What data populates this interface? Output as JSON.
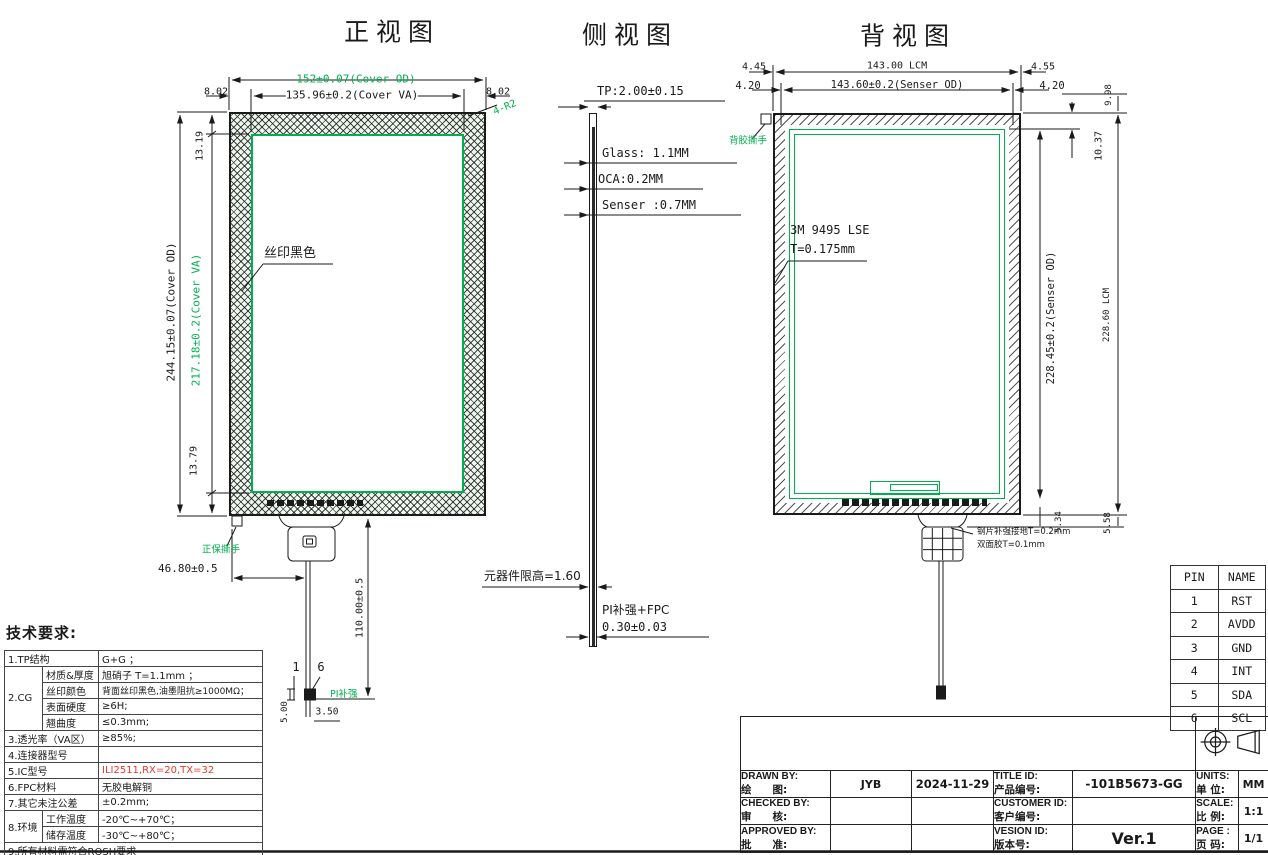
{
  "colors": {
    "line": "#1a1a1a",
    "green": "#00b050",
    "red": "#e8392c"
  },
  "front": {
    "title": "正视图",
    "dim_cover_od": "152±0.07(Cover OD)",
    "dim_cover_va": "135.96±0.2(Cover VA)",
    "margin_left": "8.02",
    "margin_right": "8.02",
    "corner": "4-R2",
    "height_od": "244.15±0.07(Cover OD)",
    "height_va": "217.18±0.2(Cover VA)",
    "top_margin": "13.19",
    "bottom_margin": "13.79",
    "silkscreen": "丝印黑色",
    "tear": "正保撕手",
    "tail_offset": "46.80±0.5",
    "tail_len": "110.00±0.5",
    "pin_start": "1",
    "pin_end": "6",
    "pad_h": "5.00",
    "pad_w": "3.50",
    "pi": "PI补强"
  },
  "side": {
    "title": "侧视图",
    "tp": "TP:2.00±0.15",
    "glass": "Glass: 1.1MM",
    "oca": "OCA:0.2MM",
    "sensor": "Senser :0.7MM",
    "comp_limit": "元器件限高=1.60",
    "pi1": "PI补强+FPC",
    "pi2": "0.30±0.03"
  },
  "back": {
    "title": "背视图",
    "m445": "4.45",
    "lcm_w": "143.00 LCM",
    "m455": "4.55",
    "m420l": "4.20",
    "senser_w": "143.60±0.2(Senser OD)",
    "m420r": "4.20",
    "tear": "背胶撕手",
    "adh1": "3M 9495 LSE",
    "adh2": "T=0.175mm",
    "m998": "9.98",
    "m1037": "10.37",
    "senser_h": "228.45±0.2(Senser OD)",
    "lcm_h": "228.60 LCM",
    "m534": "5.34",
    "m558": "5.58",
    "steel1": "钢片补强接地T=0.2mm",
    "steel2": "双面胶T=0.1mm"
  },
  "tech": {
    "heading": "技术要求:",
    "r1_label": "1.TP结构",
    "r1_value": "G+G ；",
    "cg_group": "2.CG",
    "cg1_label": "材质&厚度",
    "cg1_value": "旭硝子 T=1.1mm ；",
    "cg2_label": "丝印颜色",
    "cg2_value": "背面丝印黑色,油墨阻抗≥1000MΩ；",
    "cg3_label": "表面硬度",
    "cg3_value": "≥6H;",
    "cg4_label": "翘曲度",
    "cg4_value": "≤0.3mm;",
    "r3_label": "3.透光率（VA区）",
    "r3_value": "≥85%;",
    "r4_label": "4.连接器型号",
    "r4_value": "",
    "r5_label": "5.IC型号",
    "r5_value": "ILI2511,RX=20,TX=32",
    "r6_label": "6.FPC材料",
    "r6_value": "无胶电解铜",
    "r7_label": "7.其它未注公差",
    "r7_value": "±0.2mm;",
    "env_group": "8.环境",
    "env1_label": "工作温度",
    "env1_value": "-20℃~+70℃；",
    "env2_label": "储存温度",
    "env2_value": "-30℃~+80℃；",
    "r9_label": "9.所有材料需符合ROSH要求"
  },
  "pin_table": {
    "headers": [
      "PIN",
      "NAME"
    ],
    "rows": [
      [
        "1",
        "RST"
      ],
      [
        "2",
        "AVDD"
      ],
      [
        "3",
        "GND"
      ],
      [
        "4",
        "INT"
      ],
      [
        "5",
        "SDA"
      ],
      [
        "6",
        "SCL"
      ]
    ]
  },
  "title_block": {
    "drawn_en": "DRAWN  BY:",
    "drawn_cn": "绘　　图:",
    "drawn_value": "JYB",
    "date": "2024-11-29",
    "title_id_en": "TITLE ID:",
    "title_id_cn": "产品编号:",
    "title_id_value": "-101B5673-GG",
    "units_en": "UNITS:",
    "units_cn": "单 位:",
    "units_value": "MM",
    "checked_en": "CHECKED BY:",
    "checked_cn": "审　　核:",
    "customer_en": "CUSTOMER ID:",
    "customer_cn": "客户编号:",
    "scale_en": "SCALE:",
    "scale_cn": "比 例:",
    "scale_value": "1:1",
    "approved_en": "APPROVED BY:",
    "approved_cn": "批　　准:",
    "version_en": "VESION ID:",
    "version_cn": "版本号:",
    "version_value": "Ver.1",
    "page_en": "PAGE :",
    "page_cn": "页 码:",
    "page_value": "1/1"
  }
}
